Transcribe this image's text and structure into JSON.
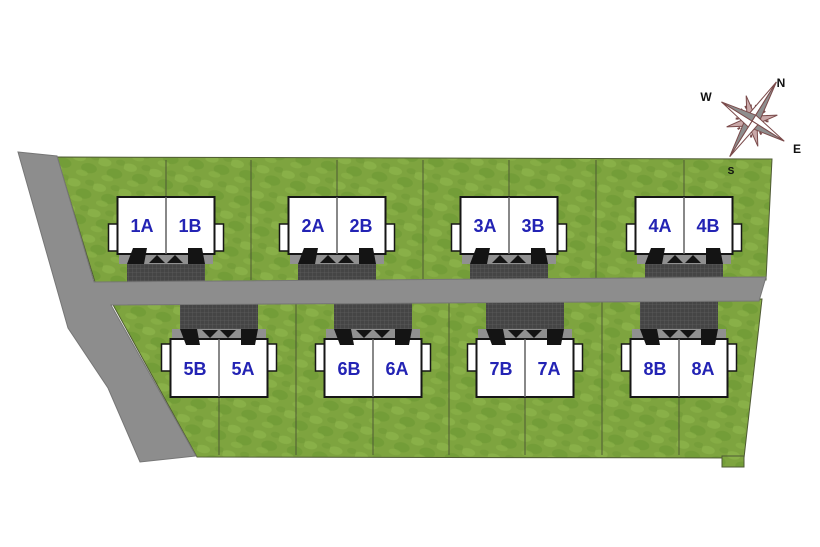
{
  "scene": {
    "width": 820,
    "height": 547,
    "kind": "duplex-siteplan"
  },
  "colors": {
    "background": "#ffffff",
    "grass_base": "#7ea43f",
    "grass_light": "#8db54c",
    "grass_dark": "#6d9834",
    "field_stroke": "#4e5a33",
    "lot_line": "#4e5a33",
    "road": "#8d8d8d",
    "road_stroke": "#767676",
    "driveway": "#454545",
    "driveway_grid": "#5e5e5e",
    "strip": "#909090",
    "steps": "#141414",
    "building_fill": "#ffffff",
    "building_stroke": "#161616",
    "divider": "#606060",
    "unit_label": "#2323b4",
    "compass_gray": "#8e8e8e",
    "compass_light": "#ffffff",
    "compass_accent": "#7b4b4b",
    "compass_secondary": "#c9a8a8",
    "compass_text": "#111111"
  },
  "compass": {
    "center": {
      "x": 752,
      "y": 121
    },
    "rotation_deg": 32,
    "main_point_lengths": {
      "n": 46,
      "e": 38,
      "s": 42,
      "w": 36
    },
    "labels": [
      {
        "text": "N",
        "x": 781,
        "y": 87,
        "size": 12
      },
      {
        "text": "W",
        "x": 706,
        "y": 101,
        "size": 12
      },
      {
        "text": "E",
        "x": 797,
        "y": 153,
        "size": 12
      },
      {
        "text": "S",
        "x": 731,
        "y": 174,
        "size": 10
      }
    ]
  },
  "site": {
    "north_field": [
      [
        57,
        157
      ],
      [
        772,
        159
      ],
      [
        766,
        280
      ],
      [
        95,
        282
      ]
    ],
    "south_field": [
      [
        112,
        303
      ],
      [
        762,
        299
      ],
      [
        744,
        458
      ],
      [
        197,
        457
      ]
    ],
    "south_notch": [
      [
        722,
        456
      ],
      [
        744,
        456
      ],
      [
        744,
        467
      ],
      [
        722,
        467
      ]
    ],
    "road": [
      [
        18,
        152
      ],
      [
        57,
        156
      ],
      [
        94,
        282
      ],
      [
        766,
        277
      ],
      [
        759,
        301
      ],
      [
        111,
        305
      ],
      [
        196,
        456
      ],
      [
        140,
        462
      ],
      [
        108,
        388
      ],
      [
        68,
        328
      ]
    ],
    "north_lot_lines": {
      "xs": [
        166,
        251,
        337,
        423,
        509,
        596,
        684
      ],
      "y1": 160,
      "y2": 280
    },
    "south_lot_lines": {
      "xs": [
        219,
        296,
        373,
        449,
        525,
        602,
        679
      ],
      "y1": 302,
      "y2": 455
    }
  },
  "rows": {
    "top": {
      "building_y": 197,
      "building_h": 57,
      "building_w": 97,
      "drive_y1": 250,
      "drive_y2": 294,
      "porch_y": 224,
      "porch_h": 27,
      "label_y": 232
    },
    "bottom": {
      "building_y": 339,
      "building_h": 58,
      "building_w": 97,
      "drive_y1": 298,
      "drive_y2": 340,
      "porch_y": 344,
      "porch_h": 27,
      "label_y": 375
    }
  },
  "buildings": [
    {
      "id": "1",
      "row": "top",
      "cx": 166,
      "units": [
        {
          "label": "1A"
        },
        {
          "label": "1B"
        }
      ]
    },
    {
      "id": "2",
      "row": "top",
      "cx": 337,
      "units": [
        {
          "label": "2A"
        },
        {
          "label": "2B"
        }
      ]
    },
    {
      "id": "3",
      "row": "top",
      "cx": 509,
      "units": [
        {
          "label": "3A"
        },
        {
          "label": "3B"
        }
      ]
    },
    {
      "id": "4",
      "row": "top",
      "cx": 684,
      "units": [
        {
          "label": "4A"
        },
        {
          "label": "4B"
        }
      ]
    },
    {
      "id": "5",
      "row": "bottom",
      "cx": 219,
      "units": [
        {
          "label": "5B"
        },
        {
          "label": "5A"
        }
      ]
    },
    {
      "id": "6",
      "row": "bottom",
      "cx": 373,
      "units": [
        {
          "label": "6B"
        },
        {
          "label": "6A"
        }
      ]
    },
    {
      "id": "7",
      "row": "bottom",
      "cx": 525,
      "units": [
        {
          "label": "7B"
        },
        {
          "label": "7A"
        }
      ]
    },
    {
      "id": "8",
      "row": "bottom",
      "cx": 679,
      "units": [
        {
          "label": "8B"
        },
        {
          "label": "8A"
        }
      ]
    }
  ]
}
